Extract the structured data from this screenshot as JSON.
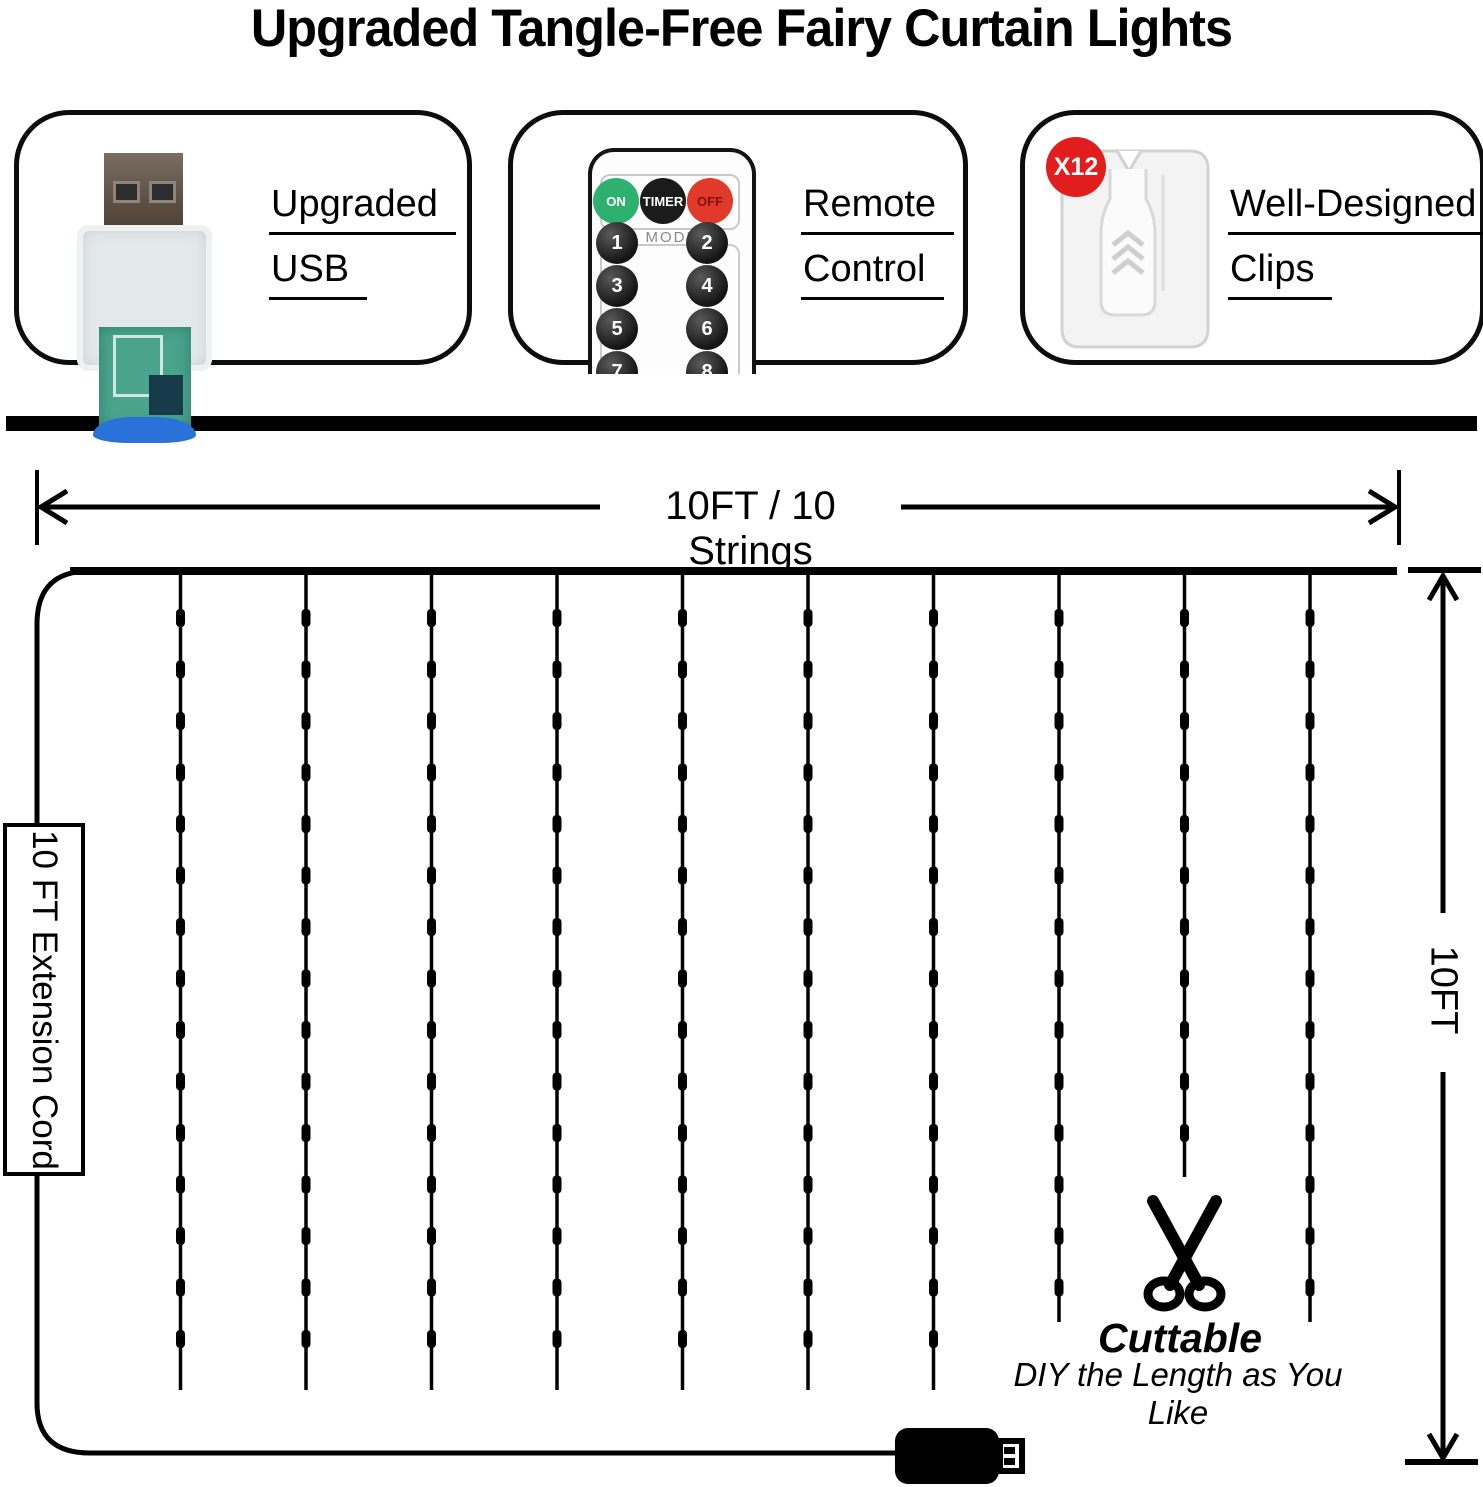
{
  "title": "Upgraded Tangle-Free Fairy Curtain Lights",
  "features": [
    {
      "line1": "Upgraded",
      "line2": "USB",
      "image": "usb-plug-photo"
    },
    {
      "line1": "Remote",
      "line2": "Control",
      "image": "remote-control-photo",
      "remote": {
        "power_buttons": [
          "ON",
          "TIMER",
          "OFF"
        ],
        "mode_label": "MODE",
        "number_buttons": [
          "1",
          "2",
          "3",
          "4",
          "5",
          "6",
          "7",
          "8"
        ]
      }
    },
    {
      "line1": "Well-Designed",
      "line2": "Clips",
      "image": "curtain-clip-photo",
      "badge": "X12"
    }
  ],
  "diagram": {
    "top_dimension_label": "10FT / 10 Strings",
    "right_dimension_label": "10FT",
    "extension_cord_label": "10 FT Extension Cord",
    "cuttable_title": "Cuttable",
    "cuttable_subtitle": "DIY the Length as You Like",
    "string_count": 10,
    "led_counts_per_string": [
      15,
      15,
      15,
      15,
      15,
      15,
      15,
      14,
      11,
      14
    ]
  },
  "colors": {
    "ink": "#000000",
    "remote_on_green": "#2eb06e",
    "remote_timer_dark": "#1b1b1b",
    "remote_off_red": "#e23a2a",
    "badge_red": "#e11d1d",
    "usb_blue": "#2a72d9",
    "pcb_green": "#49a38d"
  }
}
